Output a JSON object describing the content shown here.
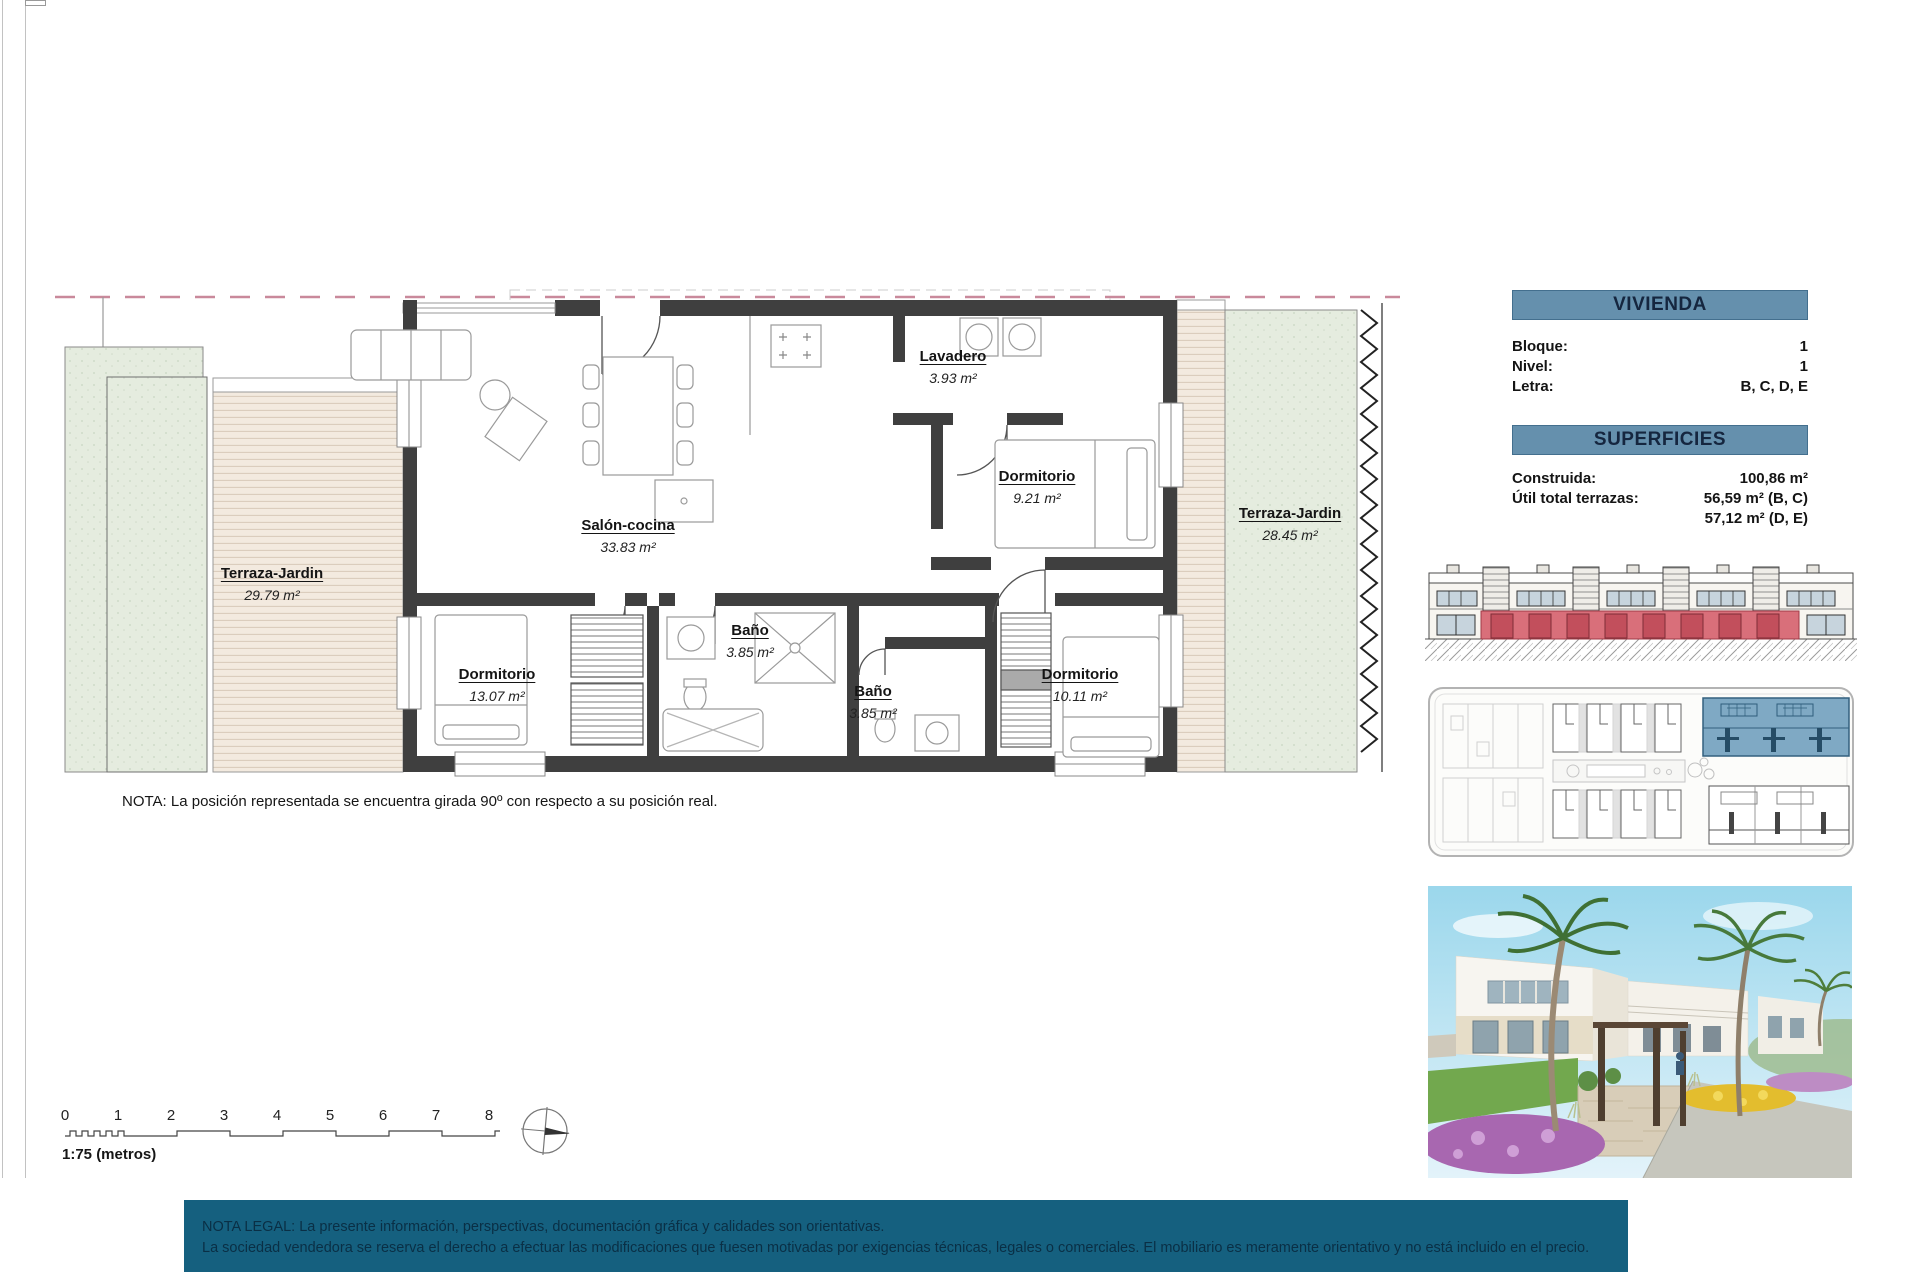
{
  "floorplan": {
    "rooms": {
      "salon": {
        "name": "Salón-cocina",
        "area": "33.83 m²"
      },
      "lavadero": {
        "name": "Lavadero",
        "area": "3.93 m²"
      },
      "dorm_921": {
        "name": "Dormitorio",
        "area": "9.21 m²"
      },
      "terraza_right": {
        "name": "Terraza-Jardin",
        "area": "28.45 m²"
      },
      "terraza_left": {
        "name": "Terraza-Jardin",
        "area": "29.79 m²"
      },
      "dorm_1307": {
        "name": "Dormitorio",
        "area": "13.07 m²"
      },
      "bano_1": {
        "name": "Baño",
        "area": "3.85 m²"
      },
      "bano_2": {
        "name": "Baño",
        "area": "3.85 m²"
      },
      "dorm_1011": {
        "name": "Dormitorio",
        "area": "10.11 m²"
      }
    },
    "note": "NOTA: La posición representada se encuentra girada 90º con respecto a su posición real."
  },
  "vivienda_panel": {
    "title": "VIVIENDA",
    "bloque_label": "Bloque:",
    "bloque_value": "1",
    "nivel_label": "Nivel:",
    "nivel_value": "1",
    "letra_label": "Letra:",
    "letra_value": "B, C, D, E"
  },
  "superficies_panel": {
    "title": "SUPERFICIES",
    "construida_label": "Construida:",
    "construida_value": "100,86 m²",
    "terrazas_label": "Útil total terrazas:",
    "terrazas_value_1": "56,59 m² (B, C)",
    "terrazas_value_2": "57,12 m² (D, E)"
  },
  "scalebar": {
    "ticks": [
      "0",
      "1",
      "2",
      "3",
      "4",
      "5",
      "6",
      "7",
      "8"
    ],
    "label": "1:75 (metros)"
  },
  "legal": {
    "line1": "NOTA LEGAL: La presente información, perspectivas, documentación gráfica y calidades son orientativas.",
    "line2": "La sociedad vendedora se reserva el derecho a efectuar las modificaciones que fuesen motivadas por exigencias técnicas, legales o comerciales. El mobiliario es meramente orientativo y no está incluido en el precio."
  },
  "colors": {
    "panel_header_bg": "#6590ad",
    "legal_bar_bg": "#15607f",
    "highlight_red": "#d96f7a",
    "highlight_blue": "#7fa9c4",
    "terrace_deck": "#f3eadf",
    "garden_green": "#e5ecdf",
    "wall": "#3f3f3f",
    "boundary_dashed": "#c9899b"
  }
}
